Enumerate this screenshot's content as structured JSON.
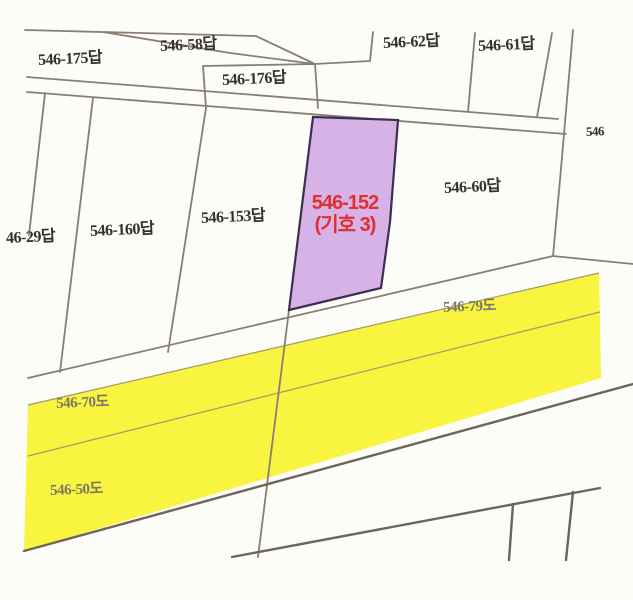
{
  "colors": {
    "background": "#fcfcf8",
    "boundary_line": "#8a7e73",
    "road_fill": "#f8f440",
    "road_edge_line": "#6f645c",
    "road_divider_line": "#a39a62",
    "highlight_fill": "#d7b2e6",
    "highlight_border": "#3c2d52",
    "highlight_text": "#e02f2f",
    "parcel_text": "#35312c",
    "road_text": "#7c7866"
  },
  "parcels": {
    "p175": "546-175답",
    "p58": "546-58답",
    "p176": "546-176답",
    "p62": "546-62답",
    "p61": "546-61답",
    "p_edge": "546",
    "p60": "546-60답",
    "p153": "546-153답",
    "p160": "546-160답",
    "p29": "46-29답"
  },
  "highlight": {
    "line1": "546-152",
    "line2": "(기호 3)"
  },
  "roads": {
    "r79": "546-79도",
    "r70": "546-70도",
    "r50": "546-50도"
  }
}
